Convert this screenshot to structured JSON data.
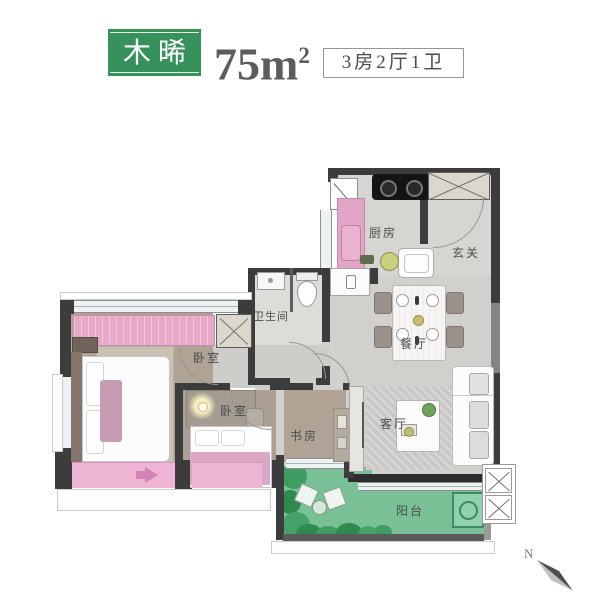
{
  "header": {
    "badge": "木晞",
    "area_value": "75m",
    "area_sup": "2",
    "spec": "3房2厅1卫"
  },
  "rooms": {
    "kitchen": "厨房",
    "foyer": "玄关",
    "bathroom": "卫生间",
    "dining": "餐厅",
    "master_bedroom": "卧室",
    "second_bedroom": "卧室",
    "study": "书房",
    "living_room": "客厅",
    "balcony": "阳台"
  },
  "compass": {
    "north": "N"
  },
  "colors": {
    "brand_green": "#36915a",
    "accent_pink": "#e8a9c8",
    "balcony_green": "#79c096",
    "wall_dark": "#3c3c3c"
  }
}
